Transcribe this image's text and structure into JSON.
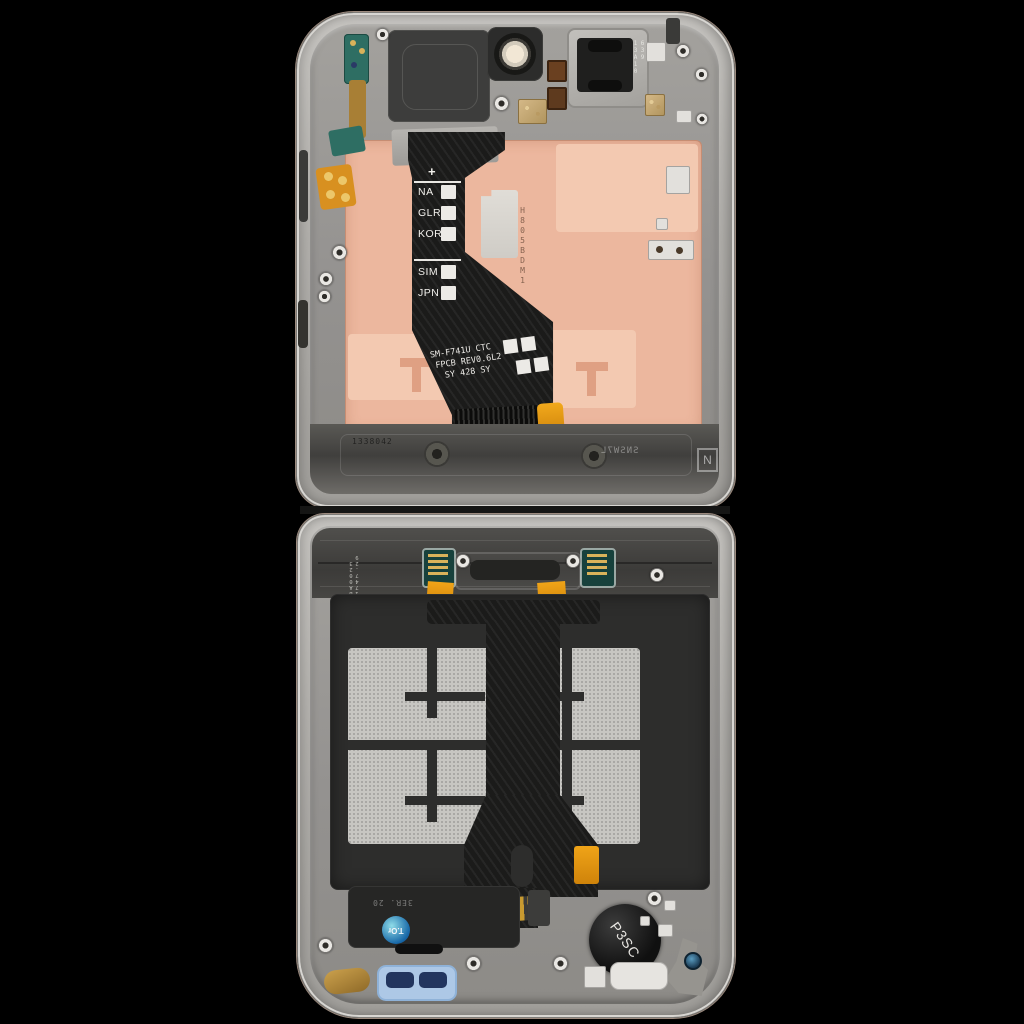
{
  "scene": {
    "description": "Folding phone internal display assembly (rear view), two halves opened flat",
    "background": "#000000"
  },
  "top_half": {
    "earpiece_code": "639 13A10",
    "region_flex": {
      "plus_mark": "+",
      "labels": [
        "NA",
        "GLR",
        "KOR",
        "SIM",
        "JPN"
      ]
    },
    "main_flex": {
      "model_line": "SM-F741U CTC",
      "rev_line": "FPCB REV0.6L2",
      "date_line": "SY 428 SY"
    },
    "board_etch_code": "H805BDM1",
    "frame_stamp_left": "1338042",
    "frame_stamp_right": "SNSW7L",
    "frame_letter": "N"
  },
  "bottom_half": {
    "edge_code": "BA0023 1747.29",
    "speaker_stamp": "3ER. 20",
    "qc_sticker_label": "T.Or",
    "vibration_motor_label": "P3SC"
  },
  "colors": {
    "frame_metal": "#b5b3af",
    "deck_gray": "#999792",
    "pcb_copper": "#ecb79e",
    "pcb_copper_light": "#f3c9b1",
    "flex_black": "#1b1b1a",
    "adhesive_gray": "#c7c6c2",
    "flex_orange": "#e8930c",
    "gasket_blue": "#adc8e6",
    "connector_teal": "#17413c",
    "sticker_blue": "#1868a8"
  }
}
